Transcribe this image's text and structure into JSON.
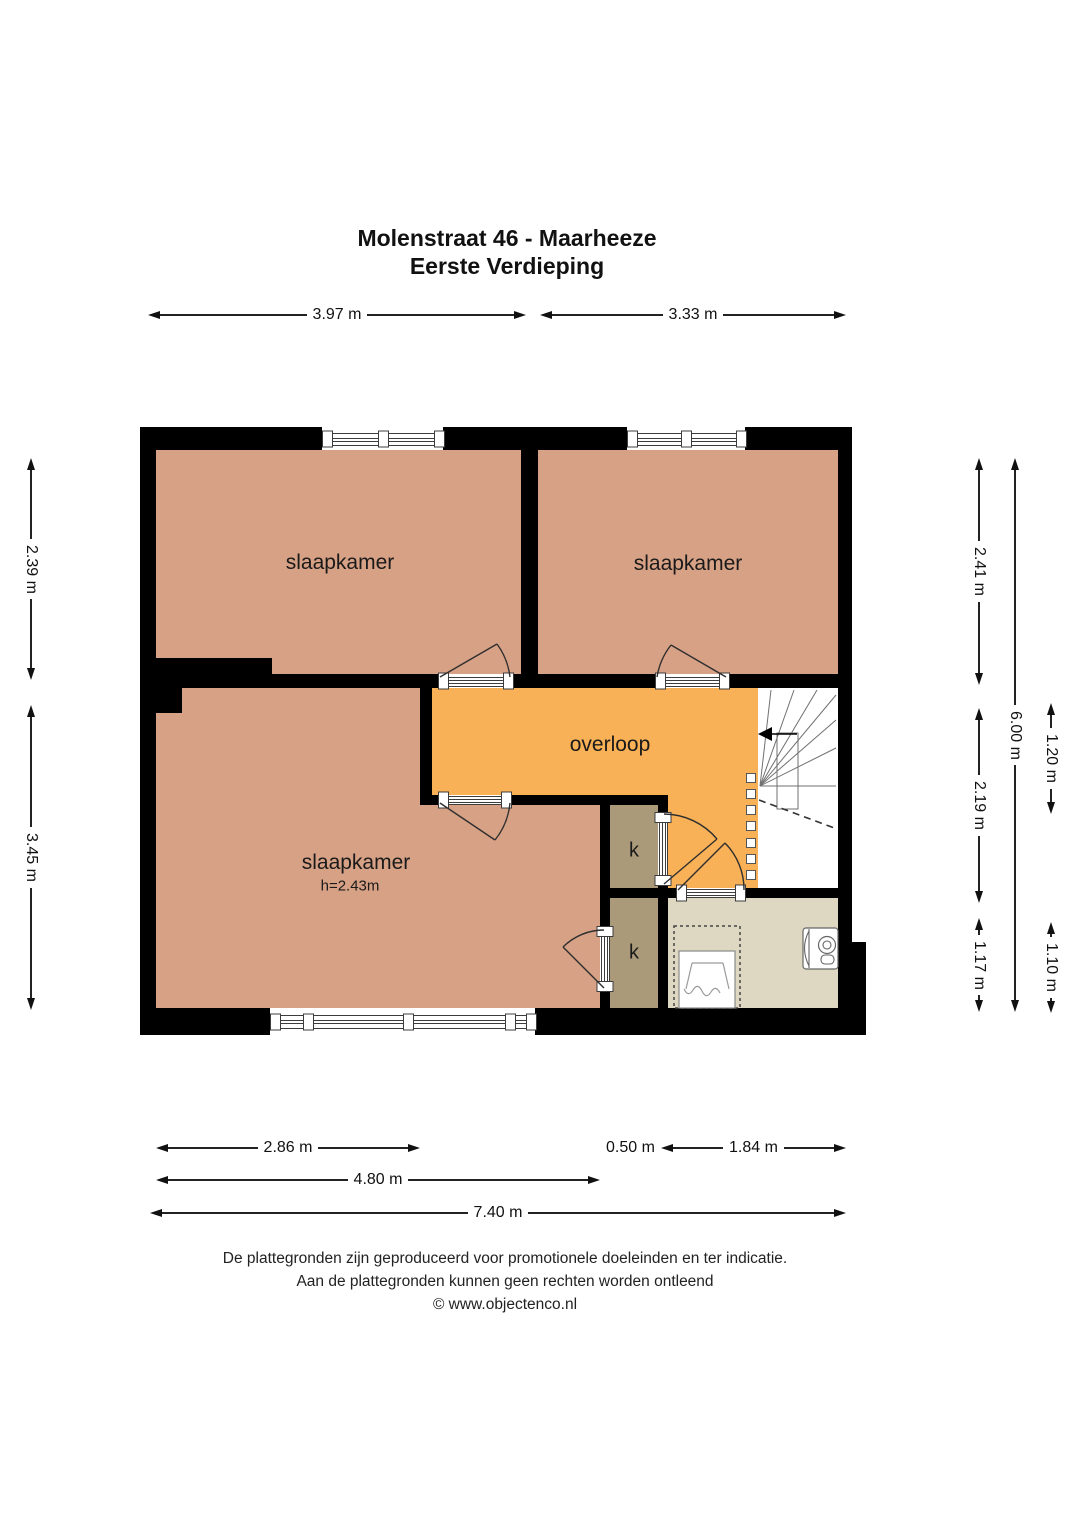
{
  "title": {
    "line1": "Molenstraat 46 - Maarheeze",
    "line2": "Eerste Verdieping"
  },
  "rooms": {
    "bedroom_top_left": {
      "label": "slaapkamer"
    },
    "bedroom_top_right": {
      "label": "slaapkamer"
    },
    "bedroom_large": {
      "label": "slaapkamer",
      "ceiling_height": "h=2.43m"
    },
    "landing": {
      "label": "overloop"
    },
    "closet_upper": {
      "label": "k"
    },
    "closet_lower": {
      "label": "k"
    }
  },
  "dimensions": {
    "top": [
      {
        "label": "3.97 m"
      },
      {
        "label": "3.33 m"
      }
    ],
    "left": [
      {
        "label": "2.39 m"
      },
      {
        "label": "3.45 m"
      }
    ],
    "right_inner": [
      {
        "label": "2.41 m"
      },
      {
        "label": "2.19 m"
      },
      {
        "label": "1.17 m"
      }
    ],
    "right_total": {
      "label": "6.00 m"
    },
    "right_outer": [
      {
        "label": "1.20 m"
      },
      {
        "label": "1.10 m"
      }
    ],
    "bottom_row1": {
      "seg1": {
        "label": "2.86 m"
      },
      "seg2_small": {
        "label": "0.50 m"
      },
      "seg2": {
        "label": "1.84 m"
      }
    },
    "bottom_row2": {
      "label": "4.80 m"
    },
    "bottom_row3": {
      "label": "7.40 m"
    }
  },
  "footer": {
    "line1": "De plattegronden zijn geproduceerd voor promotionele doeleinden en ter indicatie.",
    "line2": "Aan de plattegronden kunnen geen rechten worden ontleend",
    "line3": "© www.objectenco.nl"
  },
  "colors": {
    "wall": "#000000",
    "bedroom": "#d7a185",
    "landing": "#f8b156",
    "closet": "#ab9a79",
    "bathroom": "#ded8c3",
    "background": "#ffffff"
  },
  "icons": {
    "stair_direction_arrow": "left-arrow",
    "door_swing": "quarter-arc",
    "window": "double-glazing-lines",
    "shower": "spray-trapezoid",
    "toilet": "cistern-top-view"
  }
}
